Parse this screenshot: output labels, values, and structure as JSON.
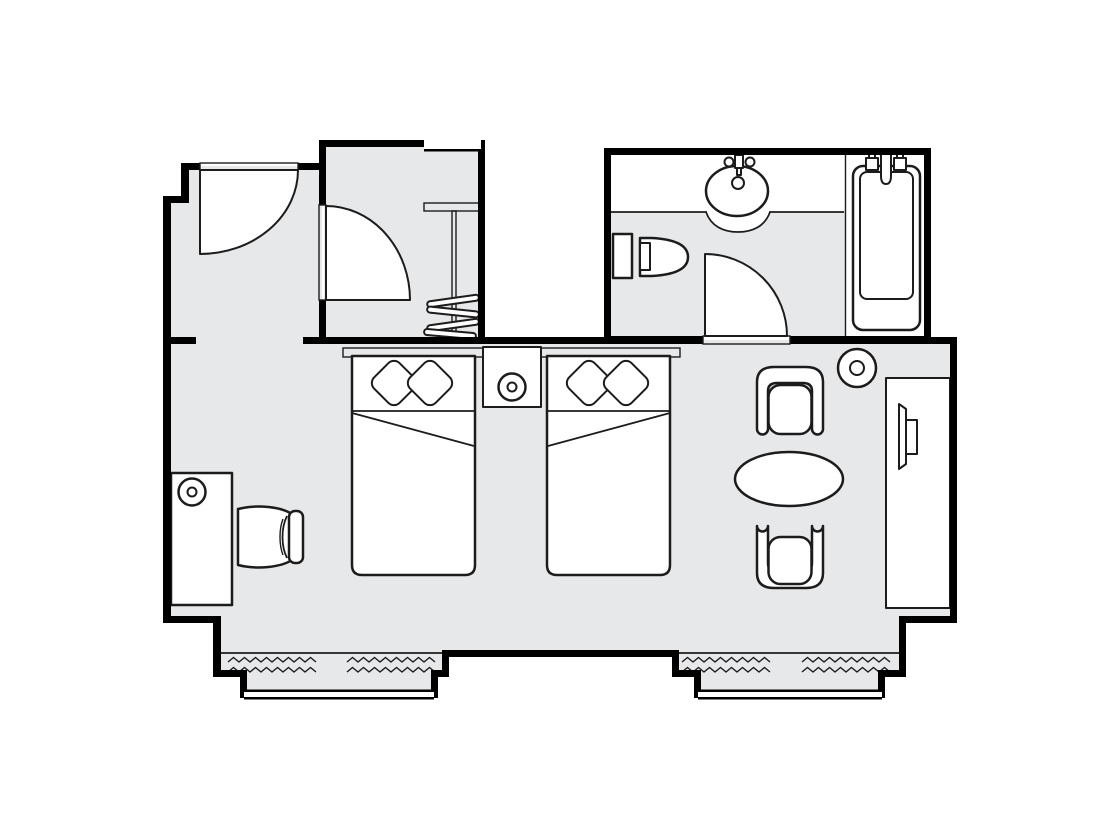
{
  "document": {
    "type": "floor-plan",
    "title": "Hotel room floor plan"
  },
  "colors": {
    "background": "#ffffff",
    "floor": "#e7e8ea",
    "wall": "#000000",
    "line": "#1c1c1c",
    "fixture": "#ffffff"
  },
  "rooms": [
    {
      "id": "entry",
      "name": "Entry hall"
    },
    {
      "id": "closet",
      "name": "Closet / wardrobe"
    },
    {
      "id": "bathroom",
      "name": "Bathroom"
    },
    {
      "id": "bedroom",
      "name": "Bedroom and sitting area"
    }
  ],
  "furniture": [
    {
      "name": "Entry door with swing"
    },
    {
      "name": "Closet door with swing"
    },
    {
      "name": "Closet shelf"
    },
    {
      "name": "Clothes rail with hangers"
    },
    {
      "name": "Washbasin on counter"
    },
    {
      "name": "Toilet"
    },
    {
      "name": "Bathtub with faucet"
    },
    {
      "name": "Bathroom door with swing"
    },
    {
      "name": "Headboard"
    },
    {
      "name": "Twin bed left with two pillows"
    },
    {
      "name": "Twin bed right with two pillows"
    },
    {
      "name": "Nightstand with lamp"
    },
    {
      "name": "Desk"
    },
    {
      "name": "Desk lamp"
    },
    {
      "name": "Desk chair"
    },
    {
      "name": "Armchair upper"
    },
    {
      "name": "Oval table"
    },
    {
      "name": "Armchair lower"
    },
    {
      "name": "Floor lamp"
    },
    {
      "name": "TV cabinet"
    },
    {
      "name": "Television"
    },
    {
      "name": "Radiator left bay"
    },
    {
      "name": "Radiator right bay"
    },
    {
      "name": "Bay window left"
    },
    {
      "name": "Bay window right"
    }
  ]
}
